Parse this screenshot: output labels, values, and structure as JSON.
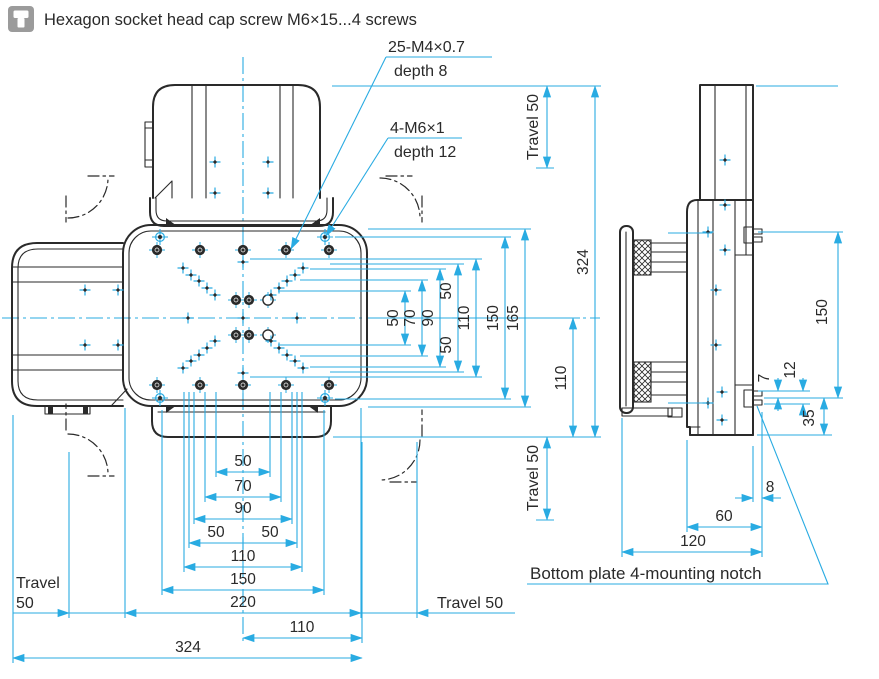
{
  "header": {
    "icon": "screw-icon",
    "title": "Hexagon socket head cap screw M6×15...4 screws"
  },
  "callouts": {
    "m4_line1": "25-M4×0.7",
    "m4_line2": "depth 8",
    "m6_line1": "4-M6×1",
    "m6_line2": "depth 12",
    "bottom_note": "Bottom plate 4-mounting notch"
  },
  "travel": {
    "top_right": "Travel 50",
    "bottom_right_v": "Travel 50",
    "bottom_right_h": "Travel 50",
    "left_line1": "Travel",
    "left_line2": "50"
  },
  "plan_h": {
    "d50": "50",
    "d70": "70",
    "d90": "90",
    "d50a": "50",
    "d50b": "50",
    "d110": "110",
    "d150": "150",
    "d220": "220",
    "d110_off": "110",
    "d324": "324"
  },
  "plan_v": {
    "d50": "50",
    "d70": "70",
    "d90": "90",
    "d50a": "50",
    "d50b": "50",
    "d110": "110",
    "d150": "150",
    "d165": "165",
    "d110_low": "110",
    "d324": "324"
  },
  "side": {
    "d150": "150",
    "d7": "7",
    "d12": "12",
    "d35": "35",
    "d8": "8",
    "d60": "60",
    "d120": "120"
  },
  "colors": {
    "outline": "#2A2A2A",
    "dimension": "#29ABE2",
    "icon_bg": "#9B9B9B",
    "background": "#FFFFFF"
  }
}
